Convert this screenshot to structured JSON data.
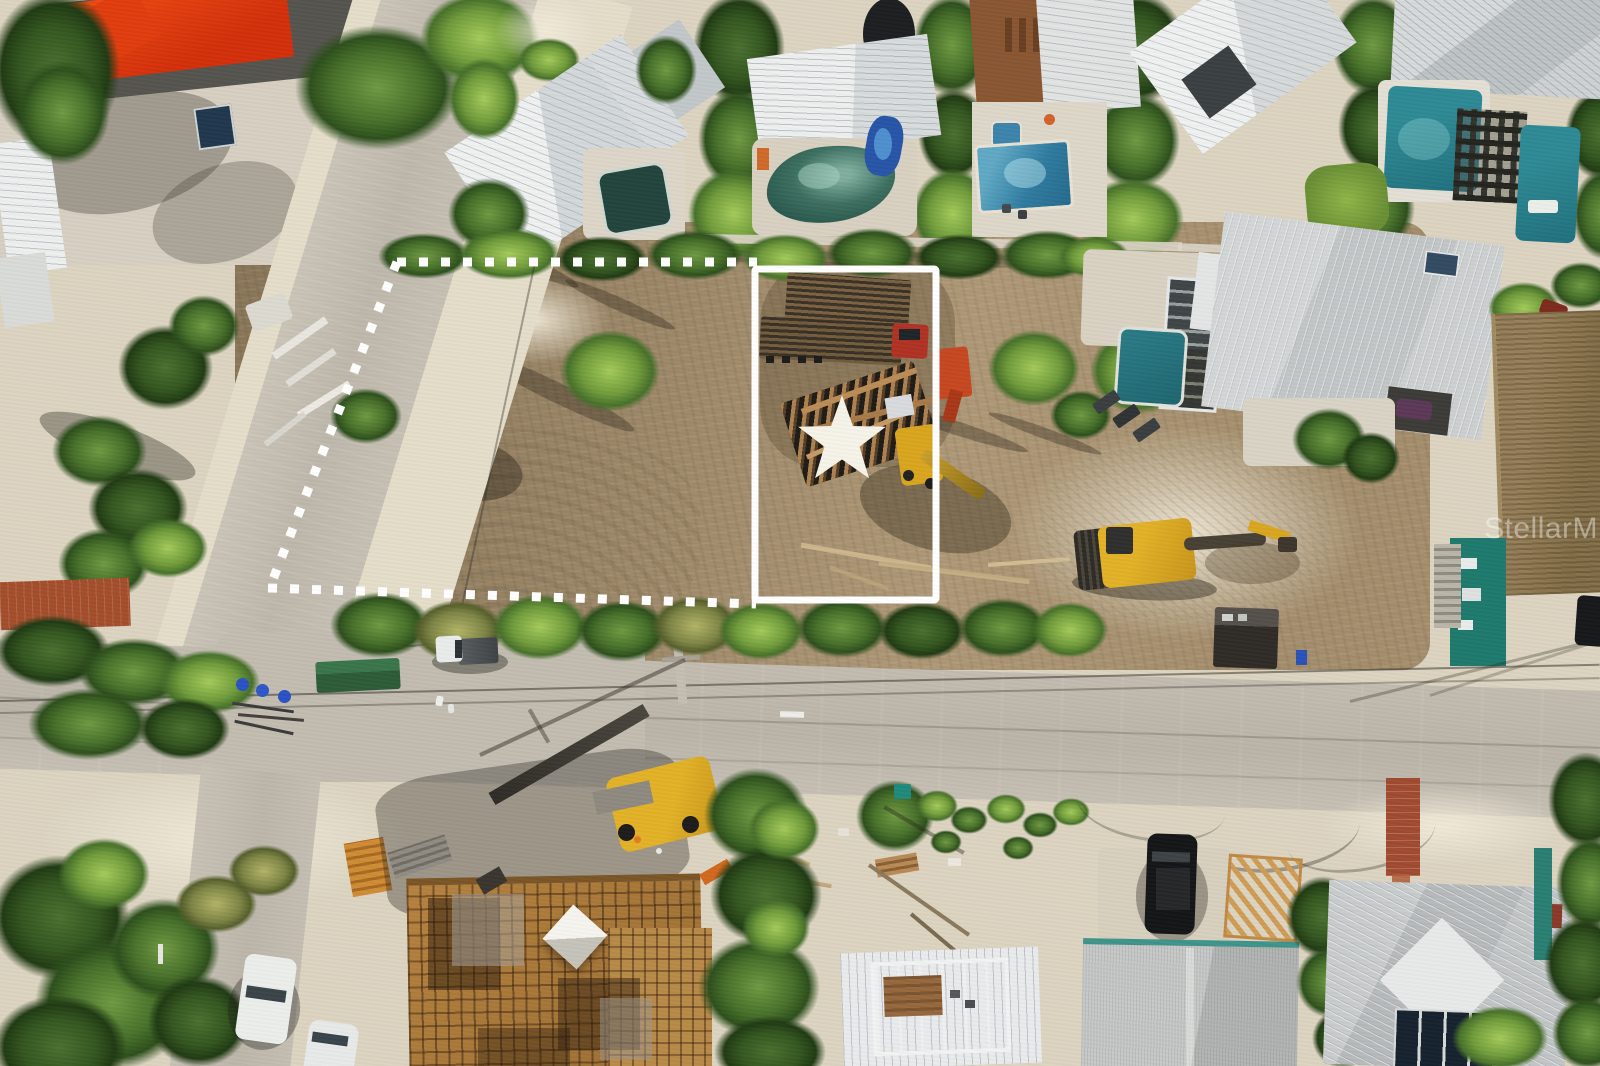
{
  "scene": {
    "type": "aerial-drone-photograph",
    "subject": "Cleared vacant coastal lot marked for sale with construction equipment, surrounded by beach houses, pools, roads and palm trees",
    "watermark": "StellarMLS"
  },
  "annotations": {
    "boundary_color": "#ffffff",
    "lot_outline_color": "#ffffff",
    "star_color": "#f6f3e9"
  },
  "palette": {
    "dirt": "#a08a67",
    "sand": "#ddd5c2",
    "road": "#c0bab0",
    "vegetation": "#4c7230",
    "pool_teal": "#2e7f8c",
    "roof_white": "#eceeee",
    "roof_gray": "#c7cbcc",
    "red_roof": "#e8400f",
    "equipment_yellow": "#d9a51f"
  },
  "objects_visible": [
    "excavator",
    "flatbed trailers with lumber",
    "truck with red cab",
    "telehandler",
    "lumber piles",
    "construction formwork deck",
    "white tarp",
    "pickup truck",
    "white car",
    "black SUV",
    "power lines",
    "swimming pools",
    "palm trees",
    "beach houses"
  ]
}
